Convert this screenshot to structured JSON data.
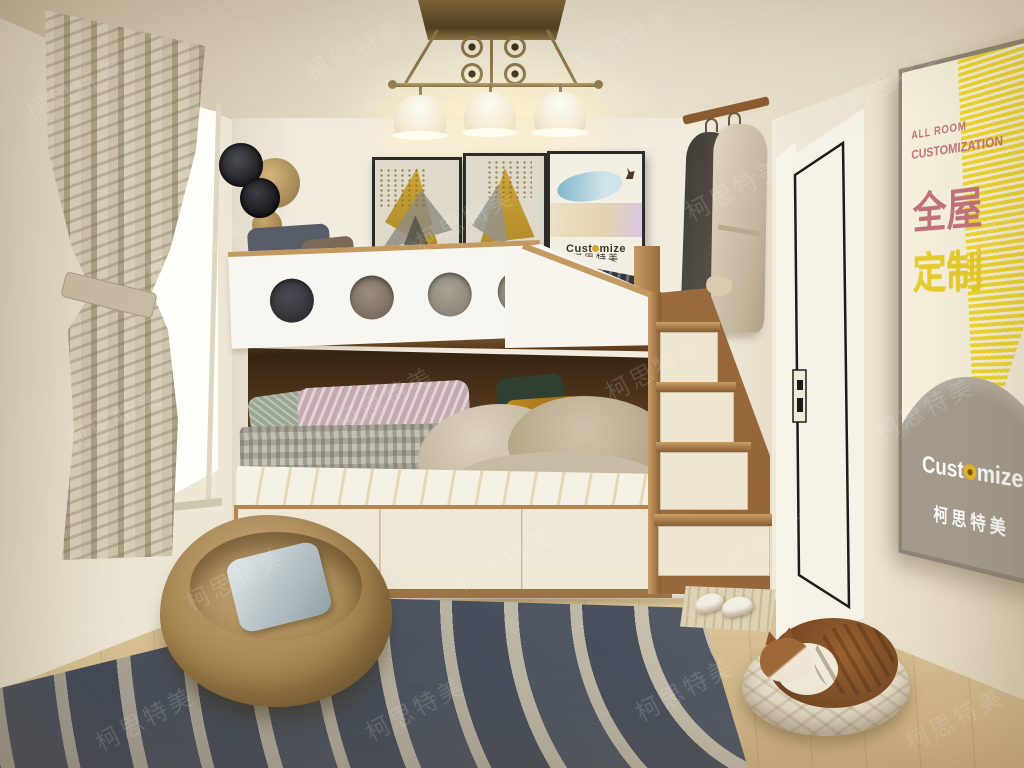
{
  "poster": {
    "kicker": "ALL ROOM",
    "headline": "CUSTOMIZATION",
    "cn_line1": "全屋",
    "cn_line2": "定制",
    "brand_prefix": "Cust",
    "brand_suffix": "mize",
    "brand_cn": "柯思特美",
    "accent_pink": "#c4727c",
    "accent_yellow": "#f0d92f",
    "dome_gray": "#a59c8e"
  },
  "wall_art": {
    "frame3_brand_prefix": "Cust",
    "frame3_brand_suffix": "mize",
    "frame3_brand_cn": "柯思特美"
  },
  "watermark": {
    "text": "柯思特美"
  }
}
